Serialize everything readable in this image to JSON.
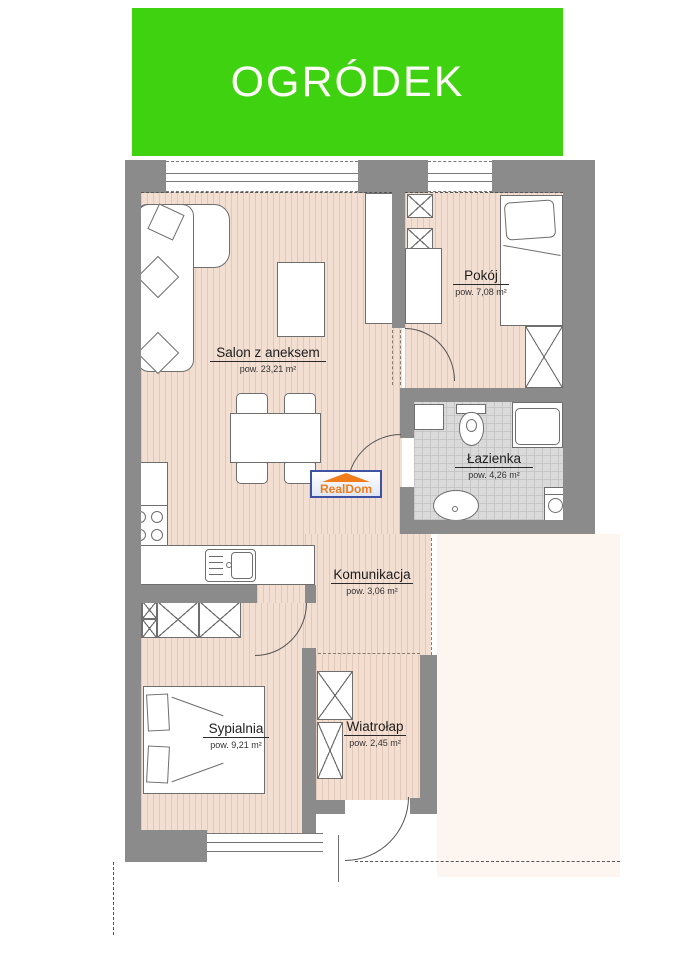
{
  "banner": {
    "title": "OGRÓDEK"
  },
  "logo": {
    "text": "RealDom"
  },
  "rooms": [
    {
      "name": "Salon z aneksem",
      "area": "pow. 23,21 m²"
    },
    {
      "name": "Pokój",
      "area": "pow. 7,08 m²"
    },
    {
      "name": "Łazienka",
      "area": "pow. 4,26 m²"
    },
    {
      "name": "Komunikacja",
      "area": "pow. 3,06 m²"
    },
    {
      "name": "Sypialnia",
      "area": "pow. 9,21 m²"
    },
    {
      "name": "Wiatrołap",
      "area": "pow. 2,45 m²"
    }
  ],
  "colors": {
    "banner-green": "#3fd211",
    "wall-gray": "#8b8b8b",
    "floor-wood": "#f2dfd2",
    "floor-tile": "#dadada",
    "outside-cream": "#fcf5f0",
    "logo-orange": "#f07d1a",
    "logo-blue": "#3f51a5"
  }
}
